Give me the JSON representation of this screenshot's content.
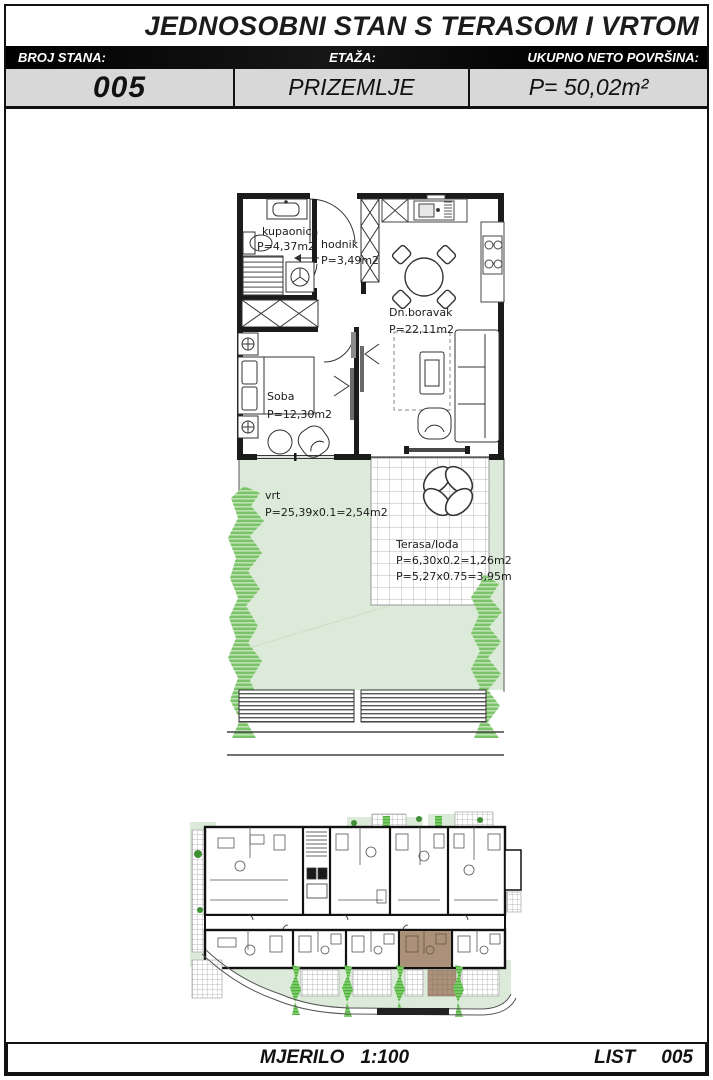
{
  "title": "JEDNOSOBNI STAN S TERASOM I VRTOM",
  "header": {
    "col1_label": "BROJ STANA:",
    "col1_value": "005",
    "col2_label": "ETAŽA:",
    "col2_value": "PRIZEMLJE",
    "col3_label": "UKUPNO NETO POVRŠINA:",
    "col3_value": "P= 50,02m²"
  },
  "plan": {
    "bathroom_name": "kupaonica",
    "bathroom_area": "P=4,37m2",
    "hall_name": "hodnik",
    "hall_area": "P=3,49m2",
    "living_name": "Dn.boravak",
    "living_area": "P=22,11m2",
    "bedroom_name": "Soba",
    "bedroom_area": "P=12,30m2",
    "garden_name": "vrt",
    "garden_area": "P=25,39x0.1=2,54m2",
    "terrace_name": "Terasa/lođa",
    "terrace_area1": "P=6,30x0.2=1,26m2",
    "terrace_area2": "P=5,27x0.75=3,95m2"
  },
  "footer": {
    "scale_label": "MJERILO",
    "scale_value": "1:100",
    "sheet_label": "LIST",
    "sheet_number": "005"
  },
  "colors": {
    "garden_green": "#dcead9",
    "hedge_green": "#79c468",
    "site_hedge_green": "#4db33a",
    "highlight_brown": "#ab9179",
    "header_gray": "#d8d8d8",
    "ink": "#1b1b1b"
  }
}
